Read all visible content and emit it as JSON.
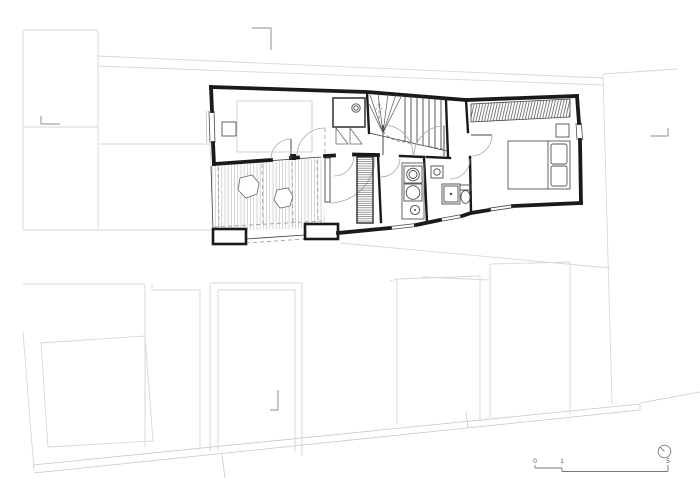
{
  "drawing": {
    "scale_bar": {
      "labels": [
        "0",
        "1",
        "5"
      ]
    },
    "symbols": [
      "north-arrow",
      "door-swing",
      "staircase",
      "shower-tray",
      "toilet",
      "washbasin",
      "appliance-front",
      "boiler",
      "bed",
      "wardrobe-hatch",
      "terrace-decking",
      "plant-blob",
      "window",
      "section-corner-mark"
    ],
    "colors": {
      "background": "#ffffff",
      "walls": "#1a1a1a",
      "interior_lines": "#3c3c3c",
      "furniture": "#555555",
      "door_arcs": "#a8a8a8",
      "site_lines": "#d7d7d7",
      "marker": "#8f8f8f",
      "scale_text": "#555555",
      "terrace_hatch": "#b8b8b8",
      "dark_hatch": "#5a5a5a"
    }
  }
}
